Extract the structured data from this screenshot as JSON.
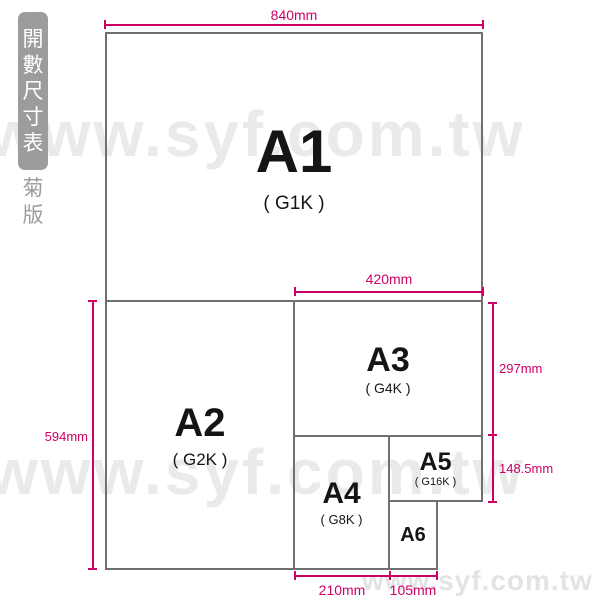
{
  "sidebar": {
    "title_chars": [
      "開",
      "數",
      "尺",
      "寸",
      "表"
    ],
    "subtitle_chars": [
      "菊",
      "版"
    ]
  },
  "watermark": {
    "text": "www.syf.com.tw"
  },
  "papers": [
    {
      "name": "A1",
      "sub": "( G1K )"
    },
    {
      "name": "A2",
      "sub": "( G2K )"
    },
    {
      "name": "A3",
      "sub": "( G4K )"
    },
    {
      "name": "A4",
      "sub": "( G8K )"
    },
    {
      "name": "A5",
      "sub": "( G16K )"
    },
    {
      "name": "A6",
      "sub": ""
    }
  ],
  "dimensions": {
    "top": "840mm",
    "inner": "420mm",
    "left": "594mm",
    "right_upper": "297mm",
    "right_lower": "148.5mm",
    "bottom_left": "210mm",
    "bottom_right": "105mm"
  },
  "colors": {
    "accent": "#cc0066",
    "box_border": "#707070",
    "sidebar_bg": "#9c9c9c",
    "watermark": "#eaeaea",
    "label_text": "#151515"
  }
}
